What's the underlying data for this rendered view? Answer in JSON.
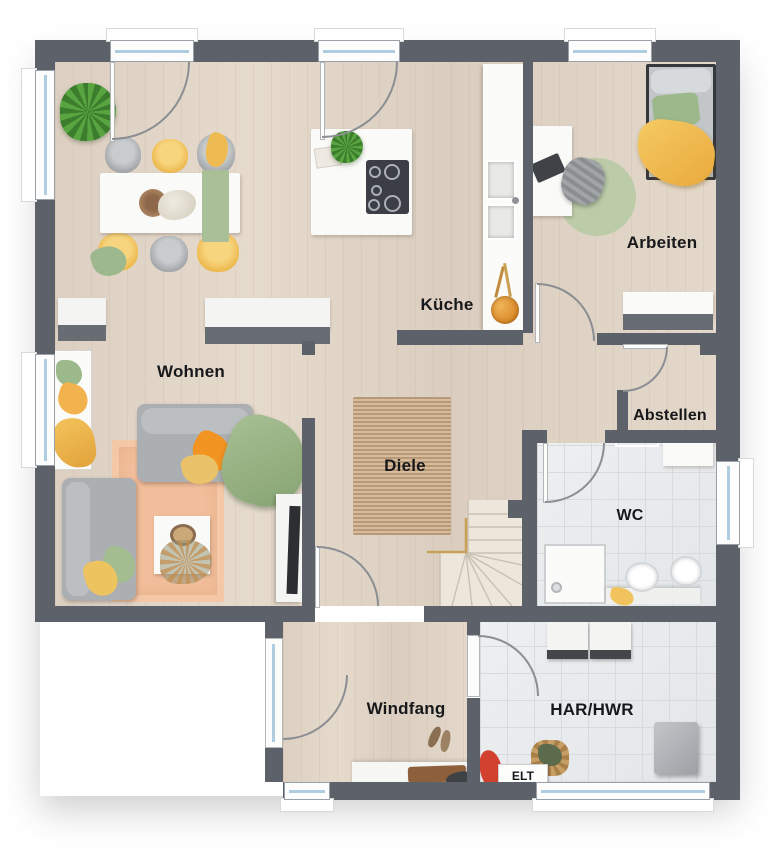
{
  "plan": {
    "type": "floor-plan",
    "rooms": {
      "kueche": {
        "label": "Küche"
      },
      "arbeiten": {
        "label": "Arbeiten"
      },
      "abstellen": {
        "label": "Abstellen"
      },
      "wc": {
        "label": "WC"
      },
      "wohnen": {
        "label": "Wohnen"
      },
      "diele": {
        "label": "Diele"
      },
      "windfang": {
        "label": "Windfang"
      },
      "har_hwr": {
        "label": "HAR/HWR"
      },
      "elt": {
        "label": "ELT"
      }
    },
    "palette": {
      "wall": "#5d616a",
      "wood_floor": "#ddd0c2",
      "tile_floor": "#e9ebed",
      "glass": "#aecde0",
      "accent_orange": "#f29422",
      "accent_yellow": "#eebb52",
      "accent_green": "#9eb88e",
      "rug_peach": "#f1bd9a",
      "rug_jute": "#cfb292",
      "rug_sage": "#b9cba6",
      "handrail_brass": "#c8a158",
      "appliance_dark": "#3b3e44"
    }
  }
}
